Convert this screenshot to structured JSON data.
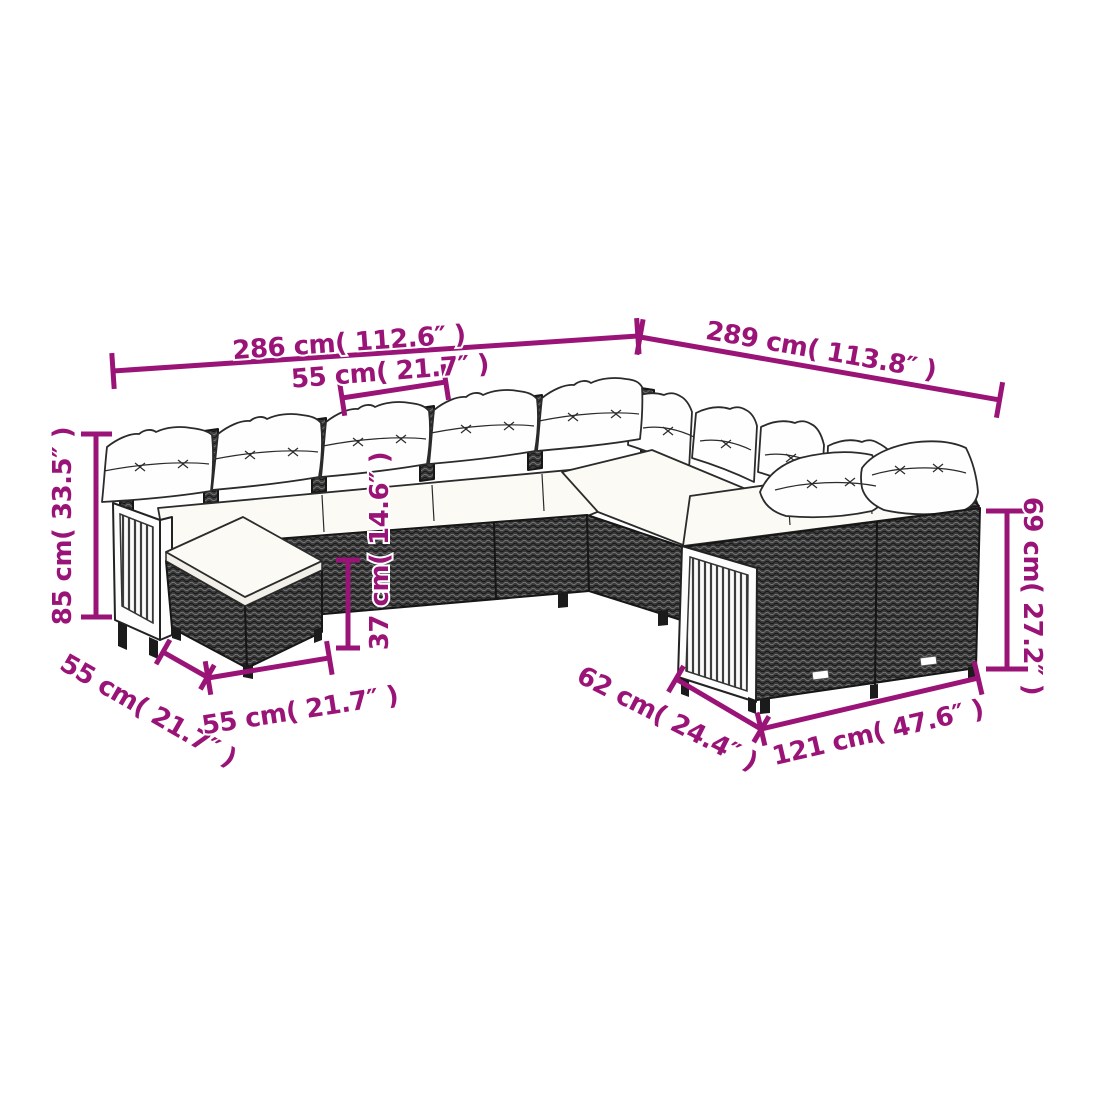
{
  "colors": {
    "background": "#ffffff",
    "accent": "#9A1477"
  },
  "dims": {
    "total_width_left": "286 cm( 112.6″ )",
    "total_width_right": "289 cm( 113.8″ )",
    "seat_width_top": "55 cm( 21.7″ )",
    "overall_height": "85 cm( 33.5″ )",
    "seat_height": "37 cm( 14.6″ )",
    "stool_depth": "55 cm( 21.7″ )",
    "stool_width": "55 cm( 21.7″ )",
    "seat_depth": "62 cm( 24.4″ )",
    "right_module_width": "121 cm( 47.6″ )",
    "backrest_height": "69 cm( 27.2″ )"
  }
}
